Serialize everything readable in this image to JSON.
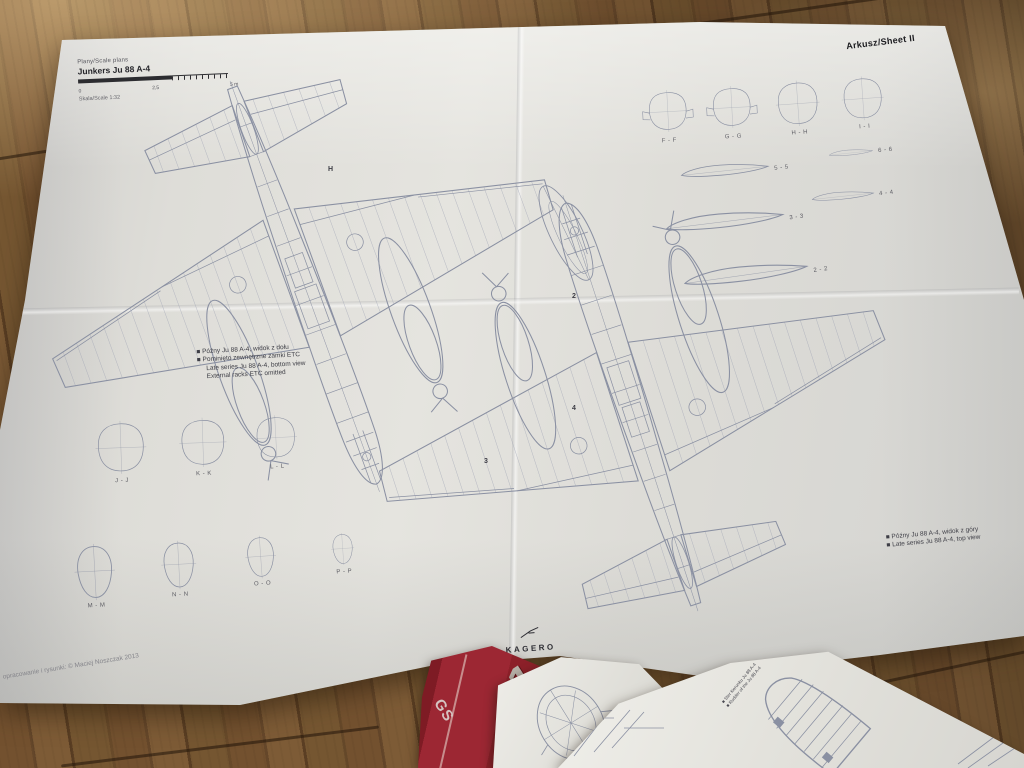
{
  "sheet": {
    "sheet_label": "Arkusz/Sheet II",
    "title_block": {
      "series": "Plany/Scale plans",
      "title": "Junkers Ju 88 A-4",
      "scale_labels": [
        "0",
        "2,5",
        "5 m"
      ],
      "scale_note": "Skala/Scale 1:32"
    },
    "captions": {
      "bottom_view": [
        "■ Późny Ju 88 A-4, widok z dołu",
        "■ Pominięto zewnętrzne zamki ETC",
        "Late series Ju 88 A-4, bottom view",
        "External racks ETC omitted"
      ],
      "top_view": [
        "■ Późny Ju 88 A-4, widok z góry",
        "■ Late series Ju 88 A-4, top view"
      ]
    },
    "sections": {
      "top_right": [
        "F - F",
        "G - G",
        "H - H",
        "I - I"
      ],
      "mid_left": [
        "J - J",
        "K - K",
        "L - L"
      ],
      "bottom_left": [
        "M - M",
        "N - N",
        "O - O",
        "P - P"
      ],
      "airfoils": [
        "5 - 5",
        "6 - 6",
        "4 - 4",
        "3 - 3",
        "2 - 2"
      ]
    },
    "markers": {
      "h": "H",
      "m2": "2",
      "m3": "3",
      "m4": "4"
    },
    "logo": "KAGERO",
    "copyright": "opracowanie i rysunki: © Maciej Noszczak 2013"
  },
  "stack": {
    "book": {
      "number": "1",
      "spine_text": "GS"
    },
    "small_label": "Ju 88 A-4",
    "inset_caption": [
      "■ Ster kierunku Ju 88 A-4",
      "■ Rudder of the Ju 88 A-4"
    ]
  },
  "colors": {
    "accent_red": "#9c2733",
    "paper": "#dddcd7",
    "line": "#8a90a2",
    "wood": "#6f4f2c"
  }
}
